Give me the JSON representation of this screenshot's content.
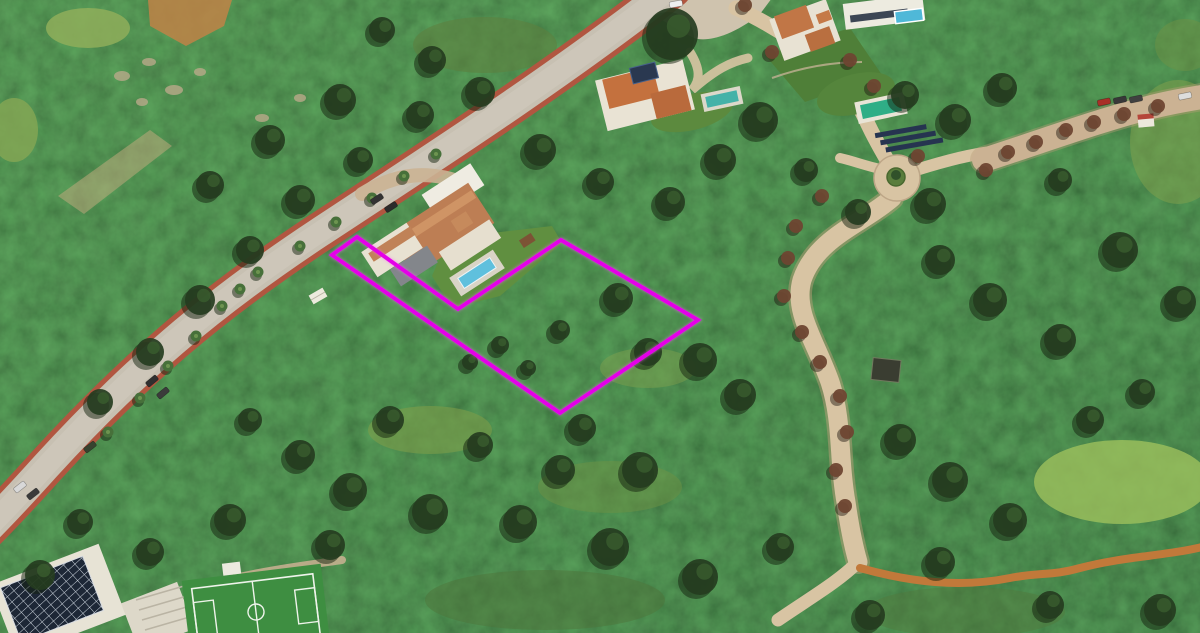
{
  "scene": {
    "kind": "aerial-photograph",
    "subject": "hillside plot of land outlined in magenta beside a large villa, surrounded by dense green scrub, winding roads and neighbouring villas",
    "width": 1200,
    "height": 633,
    "meadows": [
      [
        430,
        430,
        62,
        24,
        "#7d9c4a",
        0.6
      ],
      [
        610,
        487,
        72,
        26,
        "#6d9144",
        0.5
      ],
      [
        648,
        368,
        48,
        20,
        "#83a24e",
        0.45
      ],
      [
        1122,
        482,
        88,
        42,
        "#9dc05c",
        0.8
      ],
      [
        1178,
        142,
        48,
        62,
        "#7fa04c",
        0.55
      ],
      [
        485,
        45,
        72,
        28,
        "#5d8040",
        0.6
      ],
      [
        88,
        28,
        42,
        20,
        "#8fae5b",
        0.85
      ],
      [
        14,
        130,
        24,
        32,
        "#86a654",
        0.8
      ],
      [
        545,
        600,
        120,
        30,
        "#4e7339",
        0.5
      ],
      [
        965,
        612,
        100,
        25,
        "#52773c",
        0.45
      ],
      [
        1185,
        45,
        30,
        26,
        "#6d9144",
        0.5
      ]
    ],
    "rocks": [
      [
        122,
        76,
        8,
        5
      ],
      [
        149,
        62,
        7,
        4
      ],
      [
        174,
        90,
        9,
        5
      ],
      [
        200,
        72,
        6,
        4
      ],
      [
        142,
        102,
        6,
        4
      ],
      [
        262,
        118,
        7,
        4
      ],
      [
        300,
        98,
        6,
        4
      ],
      [
        455,
        248,
        4,
        3
      ],
      [
        432,
        252,
        4,
        3
      ]
    ],
    "trees_dark": [
      [
        672,
        34,
        26
      ],
      [
        930,
        204,
        16
      ],
      [
        858,
        212,
        13
      ],
      [
        806,
        170,
        12
      ],
      [
        618,
        298,
        15
      ],
      [
        648,
        352,
        14
      ],
      [
        582,
        428,
        14
      ],
      [
        700,
        360,
        17
      ],
      [
        740,
        395,
        16
      ],
      [
        640,
        470,
        18
      ],
      [
        560,
        470,
        15
      ],
      [
        480,
        445,
        13
      ],
      [
        390,
        420,
        14
      ],
      [
        300,
        455,
        15
      ],
      [
        250,
        420,
        12
      ],
      [
        350,
        490,
        17
      ],
      [
        430,
        512,
        18
      ],
      [
        520,
        522,
        17
      ],
      [
        610,
        547,
        19
      ],
      [
        700,
        577,
        18
      ],
      [
        780,
        547,
        14
      ],
      [
        900,
        440,
        16
      ],
      [
        950,
        480,
        18
      ],
      [
        1010,
        520,
        17
      ],
      [
        940,
        562,
        15
      ],
      [
        1090,
        420,
        14
      ],
      [
        1142,
        392,
        13
      ],
      [
        1060,
        340,
        16
      ],
      [
        990,
        300,
        17
      ],
      [
        940,
        260,
        15
      ],
      [
        1120,
        250,
        18
      ],
      [
        1180,
        302,
        16
      ],
      [
        1060,
        180,
        12
      ],
      [
        905,
        95,
        14
      ],
      [
        955,
        120,
        16
      ],
      [
        1002,
        88,
        15
      ],
      [
        760,
        120,
        18
      ],
      [
        720,
        160,
        16
      ],
      [
        670,
        202,
        15
      ],
      [
        600,
        182,
        14
      ],
      [
        540,
        150,
        16
      ],
      [
        480,
        92,
        15
      ],
      [
        432,
        60,
        14
      ],
      [
        382,
        30,
        13
      ],
      [
        560,
        330,
        10
      ],
      [
        500,
        345,
        9
      ],
      [
        528,
        368,
        8
      ],
      [
        470,
        362,
        8
      ],
      [
        300,
        200,
        15
      ],
      [
        250,
        250,
        14
      ],
      [
        200,
        300,
        15
      ],
      [
        150,
        352,
        14
      ],
      [
        100,
        402,
        13
      ],
      [
        360,
        160,
        13
      ],
      [
        420,
        115,
        14
      ],
      [
        340,
        100,
        16
      ],
      [
        270,
        140,
        15
      ],
      [
        210,
        185,
        14
      ],
      [
        230,
        520,
        16
      ],
      [
        150,
        552,
        14
      ],
      [
        80,
        522,
        13
      ],
      [
        40,
        575,
        15
      ],
      [
        330,
        545,
        15
      ],
      [
        1160,
        610,
        16
      ],
      [
        1050,
        605,
        14
      ],
      [
        870,
        615,
        15
      ]
    ],
    "trees_rust": [
      [
        822,
        196
      ],
      [
        796,
        226
      ],
      [
        788,
        258
      ],
      [
        784,
        296
      ],
      [
        802,
        332
      ],
      [
        820,
        362
      ],
      [
        840,
        396
      ],
      [
        847,
        432
      ],
      [
        836,
        470
      ],
      [
        845,
        506
      ],
      [
        1008,
        152
      ],
      [
        1036,
        142
      ],
      [
        1066,
        130
      ],
      [
        1094,
        122
      ],
      [
        1124,
        114
      ],
      [
        1158,
        106
      ],
      [
        986,
        170
      ],
      [
        874,
        86
      ],
      [
        850,
        60
      ],
      [
        772,
        52
      ],
      [
        745,
        5
      ],
      [
        918,
        156
      ]
    ],
    "palms": [
      [
        258,
        272
      ],
      [
        240,
        289
      ],
      [
        222,
        306
      ],
      [
        196,
        336
      ],
      [
        168,
        366
      ],
      [
        140,
        398
      ],
      [
        108,
        432
      ],
      [
        300,
        246
      ],
      [
        336,
        222
      ],
      [
        372,
        198
      ],
      [
        404,
        176
      ],
      [
        436,
        154
      ]
    ],
    "cars": [
      [
        20,
        487,
        -38,
        "#d8d8d8"
      ],
      [
        33,
        494,
        -38,
        "#3a3a3a"
      ],
      [
        90,
        447,
        -38,
        "#37422f"
      ],
      [
        152,
        381,
        -40,
        "#2f2f2f"
      ],
      [
        163,
        393,
        -40,
        "#3b3b3b"
      ],
      [
        377,
        199,
        -33,
        "#333333"
      ],
      [
        391,
        207,
        -33,
        "#2b2b2b"
      ],
      [
        676,
        4,
        -10,
        "#eeeeee"
      ],
      [
        1104,
        102,
        -12,
        "#a83028"
      ],
      [
        1120,
        100,
        -12,
        "#383838"
      ],
      [
        1136,
        99,
        -12,
        "#404040"
      ],
      [
        1185,
        96,
        -12,
        "#dddddd"
      ]
    ]
  },
  "plot_boundary": {
    "points": "357,237 332,255 560,413 698,320 561,240 458,309",
    "color": "#e400e8",
    "stroke_width": 4
  },
  "roads": {
    "main": {
      "d": "M 672,-12 C 565,72 448,148 320,232 C 208,306 132,372 46,466 C 28,486 10,506 -14,530"
    },
    "right_upper": {
      "d": "M 736,8 C 796,36 846,76 866,120 C 876,142 886,158 893,170"
    },
    "right_lower": {
      "d": "M 892,198 C 862,224 816,238 802,280 C 793,312 816,342 830,382 C 843,422 838,458 846,502 C 850,530 854,548 858,562"
    },
    "branch_sw": {
      "d": "M 858,562 C 838,582 810,598 778,620"
    },
    "branch_ne": {
      "d": "M 916,170 C 948,160 972,154 992,152"
    },
    "branch_w": {
      "d": "M 876,168 C 860,164 850,160 840,158"
    },
    "dirt_road": {
      "d": "M 984,160 C 1040,142 1100,120 1148,108 C 1170,102 1190,99 1208,96"
    },
    "orange_trail": {
      "d": "M 860,568 C 910,582 960,588 1010,578 C 1040,572 1052,576 1080,568 C 1125,556 1168,556 1206,546"
    },
    "pitch_path": {
      "d": "M 196,588 C 250,572 300,566 342,560"
    },
    "villa_drive": {
      "d": "M 362,194 C 398,172 430,170 466,184"
    },
    "house_drive": {
      "d": "M 690,52 C 700,68 701,80 692,90 C 715,70 730,62 748,58"
    }
  },
  "colors": {
    "base_green_1": "#4b6c3c",
    "base_green_2": "#36522e",
    "road_asphalt": "#c7c0b2",
    "road_light": "#d6d0c4",
    "road_curb_red": "#b15640",
    "road_tan": "#d8c4a3",
    "road_tan_edge": "#b99e78",
    "dirt": "#cbb293",
    "trail_orange": "#c1793a",
    "tree_dark": "#253c20",
    "tree_rust": "#6e4632",
    "palm": "#47703a",
    "rock": "#b9a98a",
    "dirt_patch": "#bf8347",
    "roof_terracotta": "#bd7e54",
    "roof_terracotta_2": "#c4713e",
    "wall_white": "#eae5d6",
    "roof_gray": "#83868b",
    "lawn": "#5f8d3e",
    "pool_blue": "#5fc0dd",
    "pool_teal": "#45b2a8",
    "pool_emerald": "#2fae86",
    "panel_dark": "#1d2736",
    "pitch_green": "#3e8e41",
    "pitch_lines": "#eef3ea"
  }
}
